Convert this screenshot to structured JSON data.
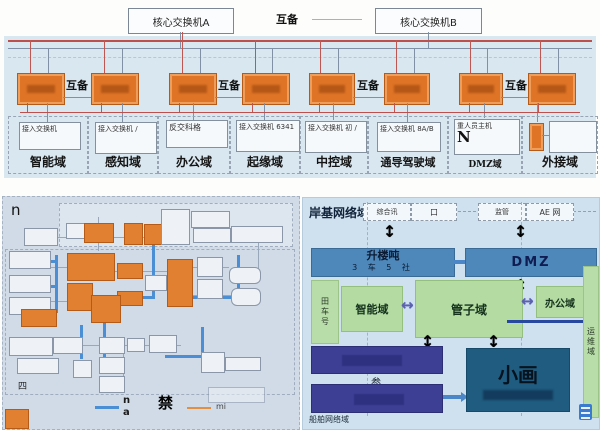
{
  "top_diagram": {
    "core_switch_a": "核心交换机A",
    "core_switch_b": "核心交换机B",
    "backup_label": "互备",
    "domains": [
      {
        "device": "接入交换机",
        "domain": "智能域"
      },
      {
        "device": "接入交换机 /",
        "domain": "感知域"
      },
      {
        "device": "反交科格",
        "domain": "办公域"
      },
      {
        "device": "接入交换机 6341",
        "domain": "起缘域"
      },
      {
        "device": "接入交换机 初 /",
        "domain": "中控域"
      },
      {
        "device": "接入交换机 8A/B",
        "domain": "通导驾驶域"
      },
      {
        "device": "重人员主机",
        "device_big": "N",
        "domain": "DMZ域"
      },
      {
        "device": "",
        "domain": "外接域"
      }
    ]
  },
  "ship_diagram": {
    "corner_label": "n",
    "side_label": "四",
    "legend": {
      "blue_line_top": "n",
      "blue_line_bottom": "a",
      "forbidden_mark": "禁",
      "orange_line_label": "mi"
    }
  },
  "shore_diagram": {
    "title": "岸基网络域",
    "top_links": [
      "综合讯",
      "口",
      "监管",
      "AE 网"
    ],
    "access_bar": {
      "title": "升楼吨",
      "subtitle": "3 车 5 社"
    },
    "dmz_bar": "DMZ",
    "left_strip": "田车号",
    "smart_zone": "智能域",
    "mgmt_zone": "管子域",
    "office_zone": "办公域",
    "right_strip": "运维域",
    "navy_label": "参",
    "core_box": "小画",
    "footer": "船舶网络域"
  },
  "colors": {
    "orange_node": "#df7426",
    "red_bus": "#bf4f4c",
    "gray_bus": "#8090a5",
    "blue_link": "#4a8fd4",
    "steel_bar": "#4e88ba",
    "green_zone": "#b4dba2",
    "navy_bar": "#3c3f94",
    "teal_box": "#1f5c80",
    "purple_arrow": "#5c60b2"
  }
}
